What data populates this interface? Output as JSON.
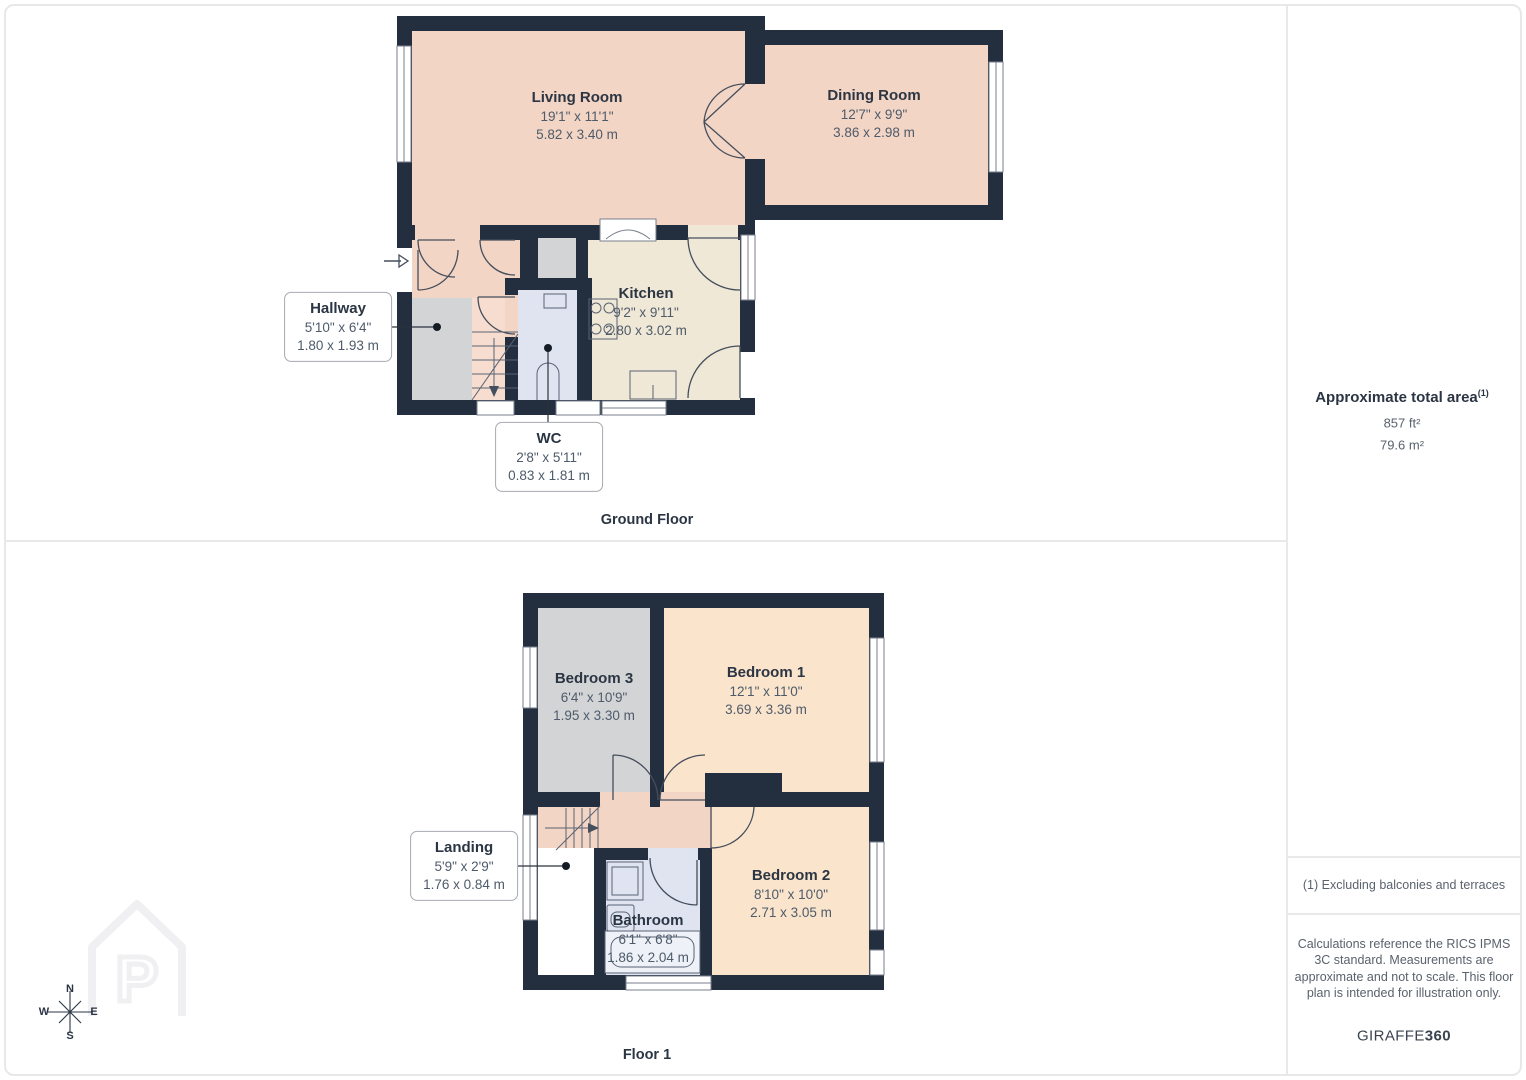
{
  "ground_floor": {
    "caption": "Ground Floor",
    "rooms": {
      "living_room": {
        "name": "Living Room",
        "size_imperial": "19'1\" x 11'1\"",
        "size_metric": "5.82 x 3.40 m"
      },
      "dining_room": {
        "name": "Dining Room",
        "size_imperial": "12'7\" x 9'9\"",
        "size_metric": "3.86 x 2.98 m"
      },
      "kitchen": {
        "name": "Kitchen",
        "size_imperial": "9'2\" x 9'11\"",
        "size_metric": "2.80 x 3.02 m"
      },
      "hallway": {
        "name": "Hallway",
        "size_imperial": "5'10\" x 6'4\"",
        "size_metric": "1.80 x 1.93 m"
      },
      "wc": {
        "name": "WC",
        "size_imperial": "2'8\" x 5'11\"",
        "size_metric": "0.83 x 1.81 m"
      }
    }
  },
  "floor_1": {
    "caption": "Floor 1",
    "rooms": {
      "bedroom_1": {
        "name": "Bedroom 1",
        "size_imperial": "12'1\" x 11'0\"",
        "size_metric": "3.69 x 3.36 m"
      },
      "bedroom_2": {
        "name": "Bedroom 2",
        "size_imperial": "8'10\" x 10'0\"",
        "size_metric": "2.71 x 3.05 m"
      },
      "bedroom_3": {
        "name": "Bedroom 3",
        "size_imperial": "6'4\" x 10'9\"",
        "size_metric": "1.95 x 3.30 m"
      },
      "bathroom": {
        "name": "Bathroom",
        "size_imperial": "6'1\" x 6'8\"",
        "size_metric": "1.86 x 2.04 m"
      },
      "landing": {
        "name": "Landing",
        "size_imperial": "5'9\" x 2'9\"",
        "size_metric": "1.76 x 0.84 m"
      }
    }
  },
  "sidebar": {
    "total_area_title": "Approximate total area",
    "total_area_footnote_marker": "(1)",
    "total_area_ft": "857 ft²",
    "total_area_m": "79.6 m²",
    "footnote": "(1) Excluding balconies and terraces",
    "disclaimer": "Calculations reference the RICS IPMS 3C standard. Measurements are approximate and not to scale. This floor plan is intended for illustration only.",
    "brand_name": "GIRAFFE",
    "brand_suffix": "360"
  },
  "compass": {
    "north": "N",
    "south": "S",
    "east": "E",
    "west": "W"
  },
  "colors": {
    "wall": "#232e3f",
    "room_peach": "#f3d5c5",
    "room_peach_light": "#fae4cc",
    "room_cream": "#f0e8d6",
    "room_gray": "#d3d4d6",
    "room_blue": "#dfe4f0",
    "label_dark": "#2b3543",
    "label_gray": "#4e5b6a",
    "divider": "#e9e9ea"
  }
}
